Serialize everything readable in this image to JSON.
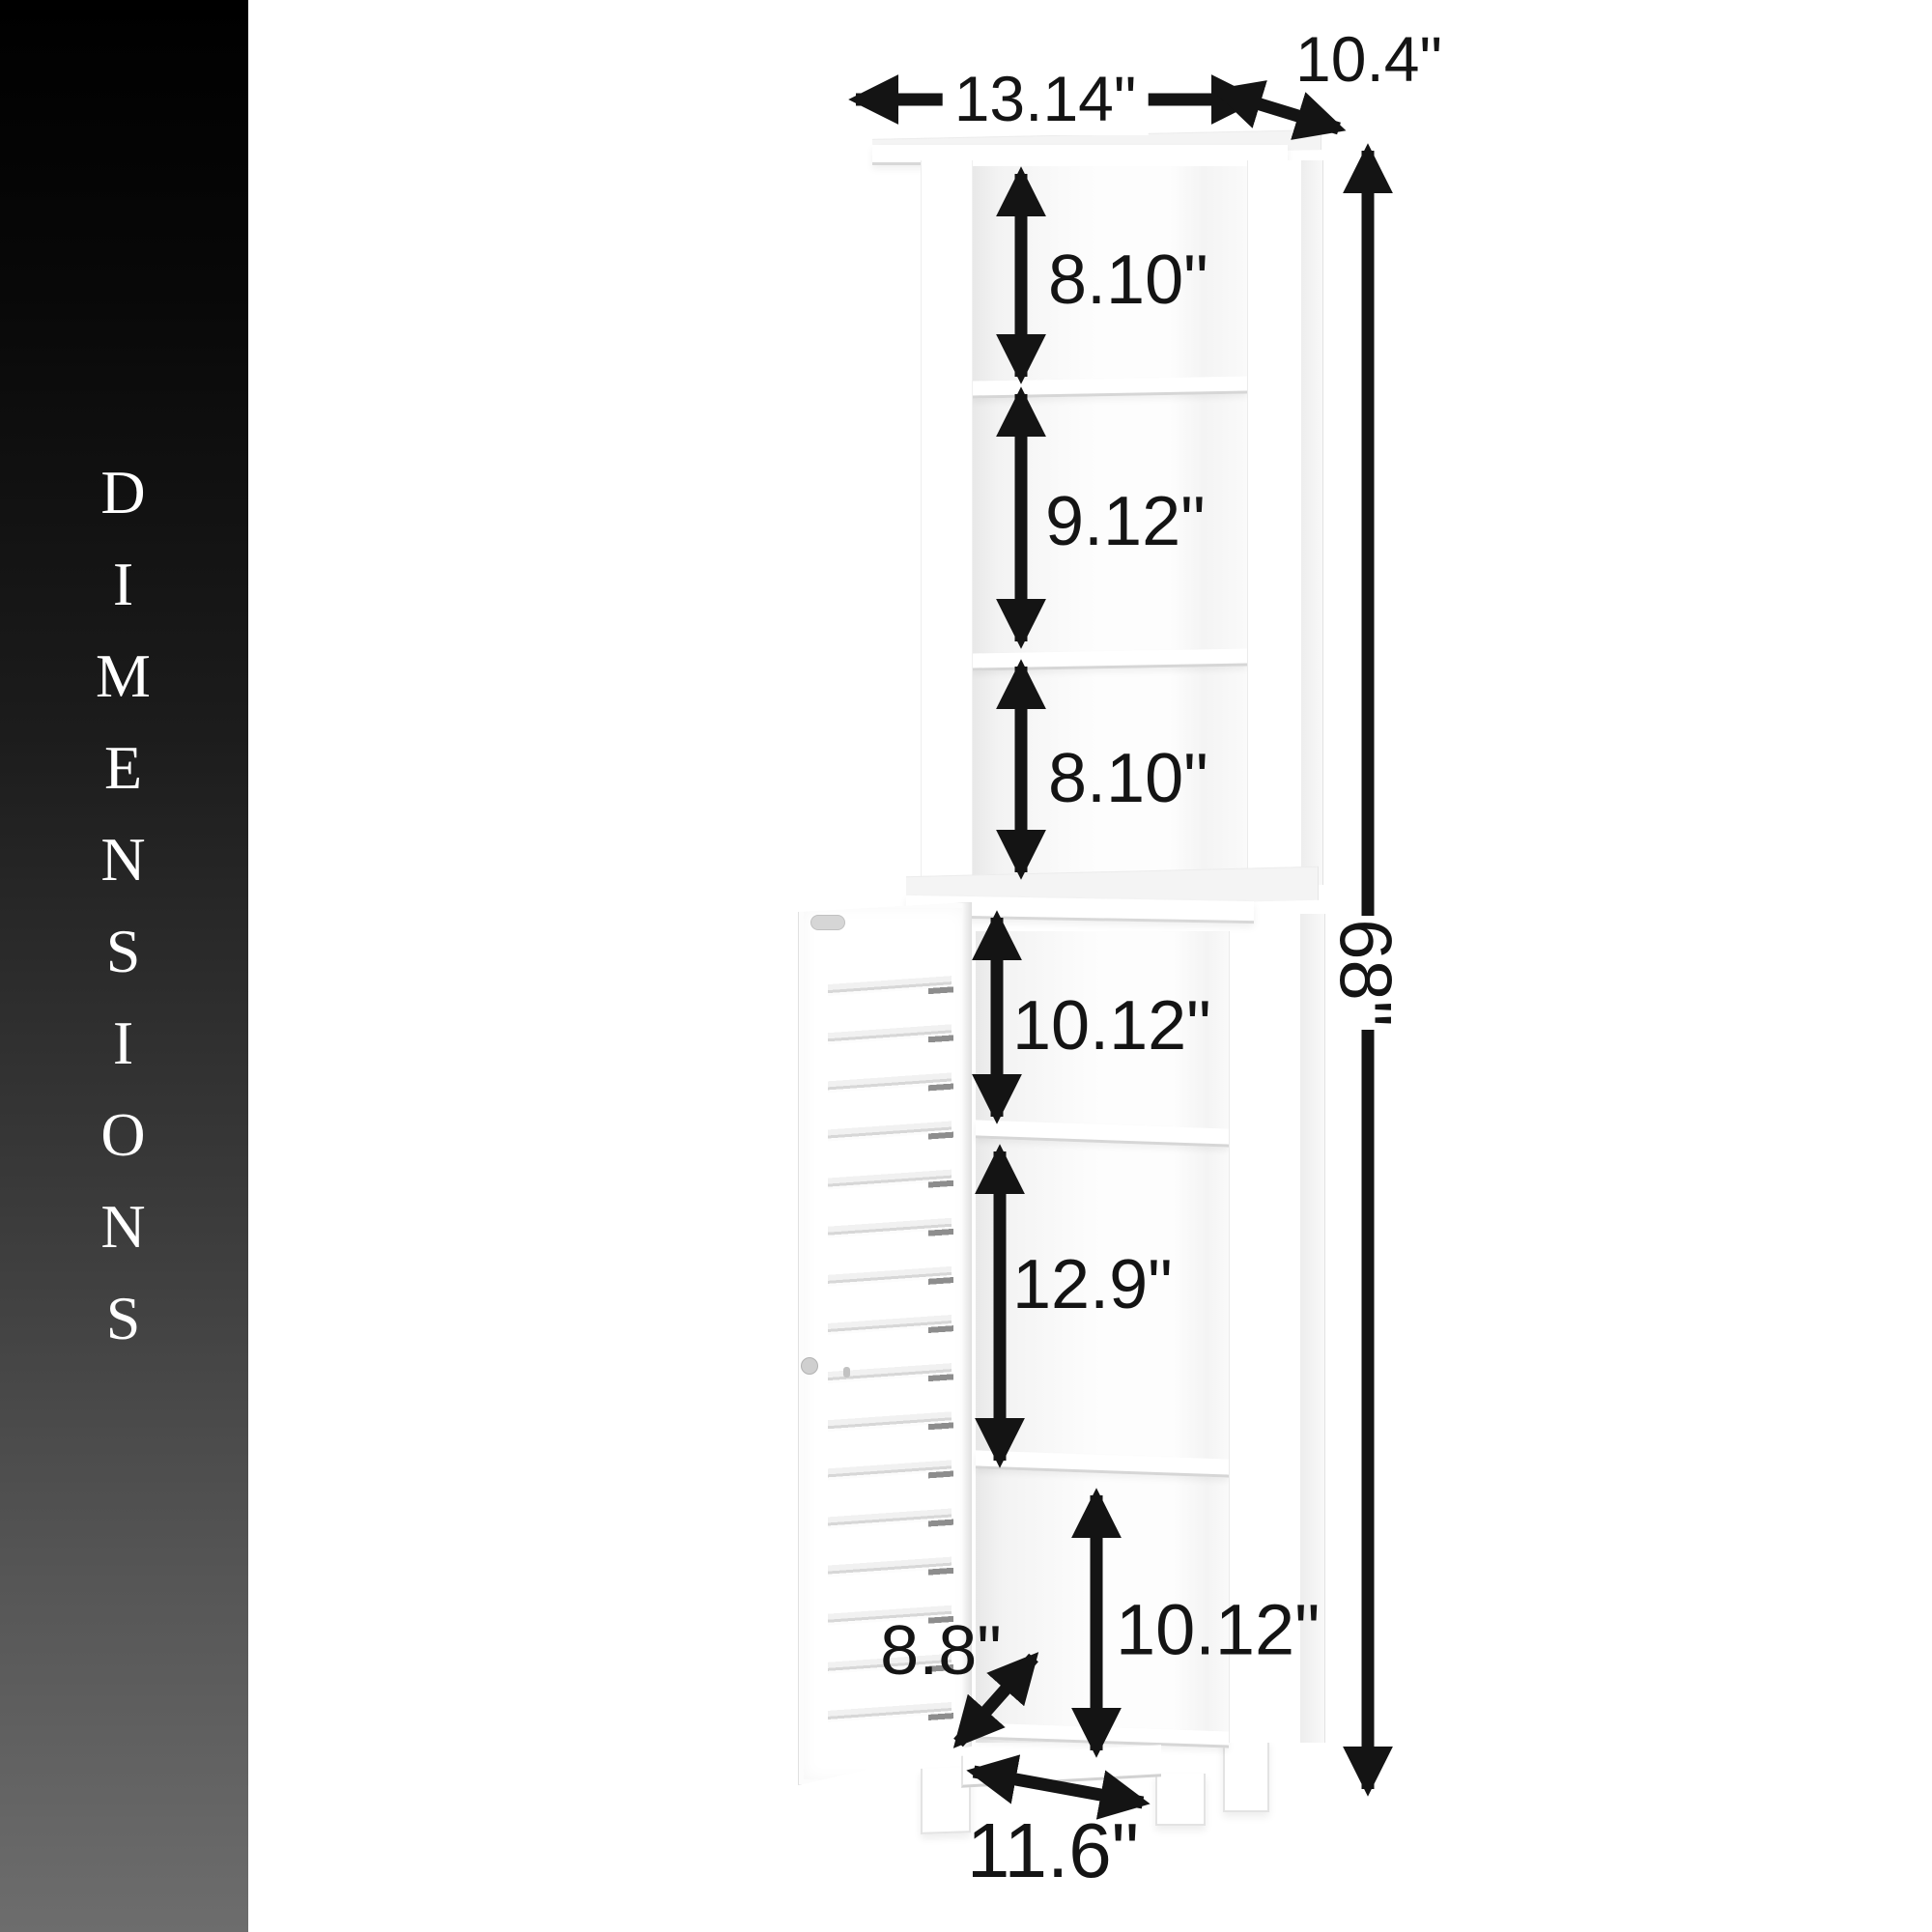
{
  "banner": {
    "vertical_title": "DIMENSIONS"
  },
  "dimension_labels": {
    "top_width": "13.14\"",
    "top_depth": "10.4\"",
    "upper_section_1": "8.10\"",
    "upper_section_2": "9.12\"",
    "upper_section_3": "8.10\"",
    "lower_section_1": "10.12\"",
    "lower_section_2": "12.9\"",
    "lower_section_3": "10.12\"",
    "door_opening_depth": "8.8\"",
    "base_width": "11.6\"",
    "overall_height": "68\""
  },
  "colors": {
    "background": "#ffffff",
    "cabinet": "#ffffff",
    "arrow": "#141414",
    "label_text": "#141414",
    "banner_gradient_top": "#000000",
    "banner_gradient_bottom": "#6d6d6d",
    "banner_text": "#ffffff"
  }
}
